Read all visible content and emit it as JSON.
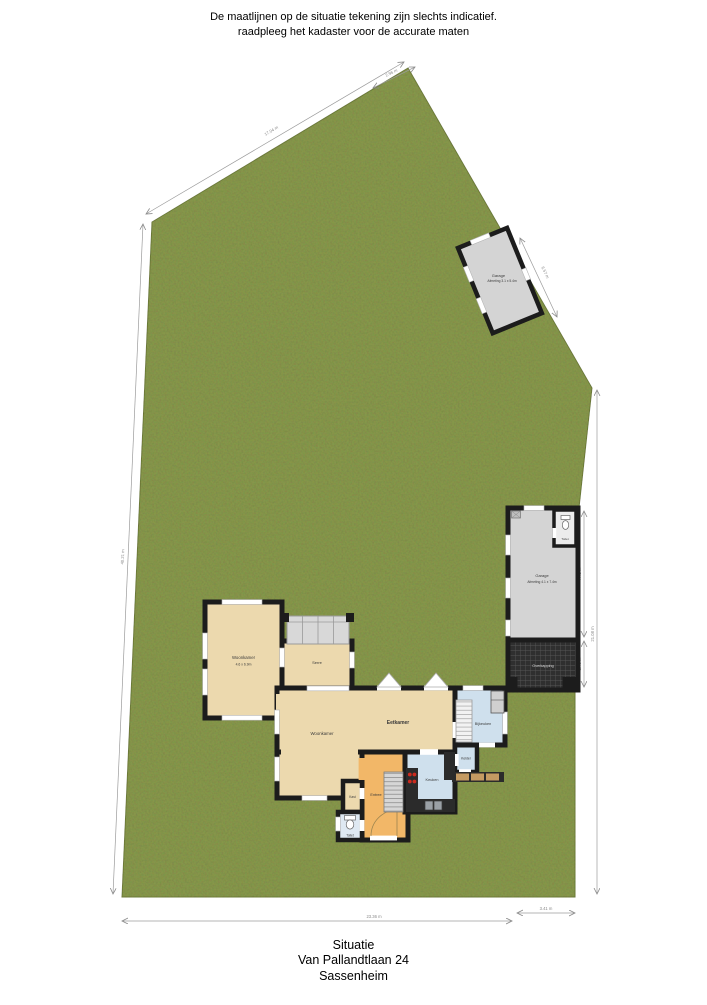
{
  "disclaimer": {
    "line1": "De maatlijnen op de situatie tekening zijn slechts indicatief.",
    "line2": "raadpleeg het kadaster voor de accurate maten"
  },
  "footer": {
    "line1": "Situatie",
    "line2": "Van Pallandtlaan 24",
    "line3": "Sassenheim"
  },
  "plot": {
    "dimensions": {
      "top_left_edge": "17.04 m",
      "top_corner_edge": "2.96 m",
      "upper_right_edge": "6.57 m",
      "left_edge": "40.21 m",
      "bottom_edge": "23.36 m",
      "bottom_right_edge": "3.41 m",
      "garage_side": "7.41 m",
      "carport_side": "2.46 m",
      "right_edge": "21.08 m"
    }
  },
  "house": {
    "rooms": {
      "woonkamer_wing": {
        "name": "Woonkamer",
        "size": "4.6 x 6.9m"
      },
      "serre": {
        "name": "Serre"
      },
      "eetkamer": {
        "name": "Eetkamer"
      },
      "woonkamer": {
        "name": "Woonkamer"
      },
      "keuken": {
        "name": "Keuken"
      },
      "kelder": {
        "name": "Kelder"
      },
      "bijkeuken": {
        "name": "Bijkeuken"
      },
      "entree": {
        "name": "Entree"
      },
      "kast": {
        "name": "Kast"
      },
      "toilet": {
        "name": "Toilet"
      }
    }
  },
  "garage_upper": {
    "name": "Garage",
    "size": "Afmeting 3.1 x 5.4m"
  },
  "garage_lower": {
    "name": "Garage",
    "size": "Afmeting 4.1 x 7.4m",
    "toilet": "Toilet",
    "carport": "Overkapping"
  },
  "colors": {
    "grass": "#87974b",
    "floor_beige": "#ecd9ae",
    "floor_orange": "#f2b768",
    "floor_blue": "#cfe0ed",
    "garage_gray": "#d4d4d4",
    "wall_black": "#1c1c1c",
    "counter_dark": "#2b2b2b",
    "cooktop_red": "#cc2a1e"
  }
}
